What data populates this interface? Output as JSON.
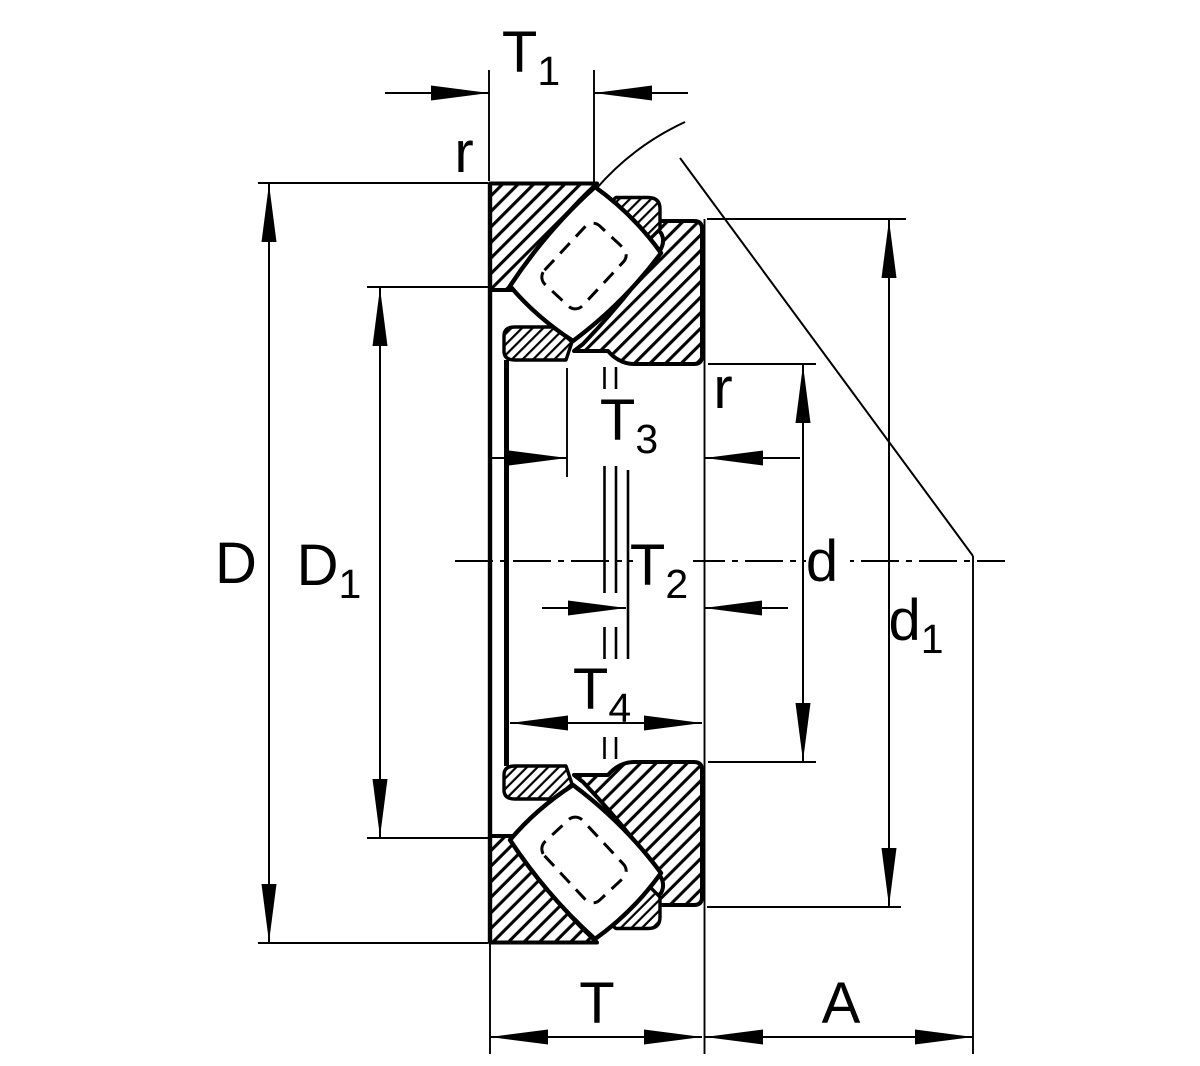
{
  "drawing": {
    "type": "bearing-cross-section",
    "labels": {
      "T1": {
        "base": "T",
        "sub": "1"
      },
      "r_top": {
        "base": "r",
        "sub": ""
      },
      "T3": {
        "base": "T",
        "sub": "3"
      },
      "r_mid": {
        "base": "r",
        "sub": ""
      },
      "T2": {
        "base": "T",
        "sub": "2"
      },
      "T4": {
        "base": "T",
        "sub": "4"
      },
      "D": {
        "base": "D",
        "sub": ""
      },
      "D1": {
        "base": "D",
        "sub": "1"
      },
      "d": {
        "base": "d",
        "sub": ""
      },
      "d1": {
        "base": "d",
        "sub": "1"
      },
      "T": {
        "base": "T",
        "sub": ""
      },
      "A": {
        "base": "A",
        "sub": ""
      }
    },
    "line_color": "#000000",
    "background_color": "#ffffff"
  }
}
